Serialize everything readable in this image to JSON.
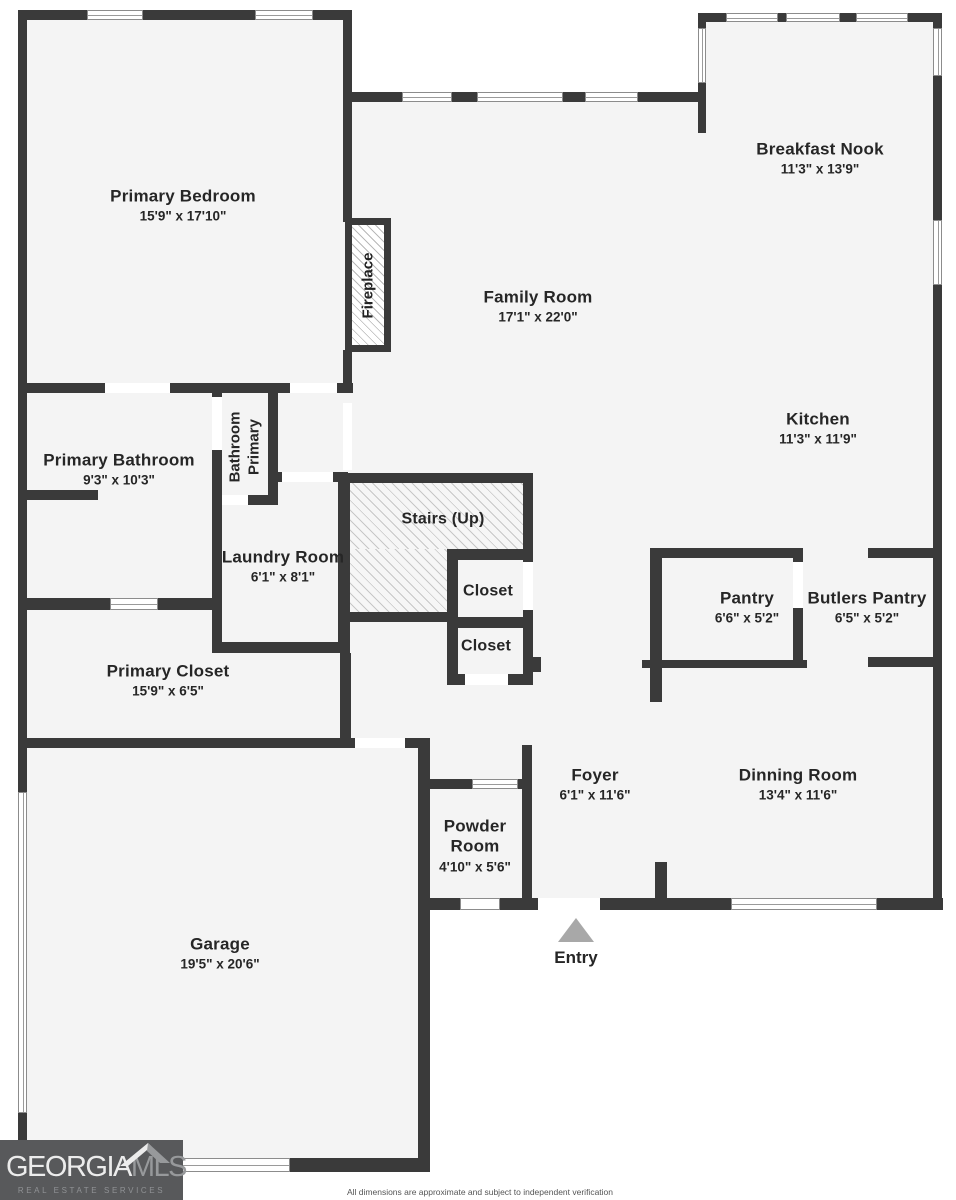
{
  "colors": {
    "wall": "#3a3a3a",
    "floor": "#f4f4f4",
    "background": "#ffffff",
    "entry_arrow": "#a8a8a8",
    "logo_background": "#58595b"
  },
  "rooms": {
    "primary_bedroom": {
      "name": "Primary Bedroom",
      "dims": "15'9\" x 17'10\""
    },
    "breakfast_nook": {
      "name": "Breakfast Nook",
      "dims": "11'3\" x 13'9\""
    },
    "family_room": {
      "name": "Family Room",
      "dims": "17'1\" x 22'0\""
    },
    "kitchen": {
      "name": "Kitchen",
      "dims": "11'3\" x 11'9\""
    },
    "primary_bathroom": {
      "name": "Primary Bathroom",
      "dims": "9'3\" x 10'3\""
    },
    "laundry_room": {
      "name": "Laundry Room",
      "dims": "6'1\" x 8'1\""
    },
    "pantry": {
      "name": "Pantry",
      "dims": "6'6\" x 5'2\""
    },
    "butlers_pantry": {
      "name": "Butlers Pantry",
      "dims": "6'5\" x 5'2\""
    },
    "primary_closet": {
      "name": "Primary Closet",
      "dims": "15'9\" x 6'5\""
    },
    "foyer": {
      "name": "Foyer",
      "dims": "6'1\" x 11'6\""
    },
    "dinning_room": {
      "name": "Dinning Room",
      "dims": "13'4\" x 11'6\""
    },
    "powder_room": {
      "name_lines": [
        "Powder",
        "Room"
      ],
      "dims": "4'10\" x 5'6\""
    },
    "garage": {
      "name": "Garage",
      "dims": "19'5\" x 20'6\""
    }
  },
  "labels": {
    "fireplace": "Fireplace",
    "stairs": "Stairs (Up)",
    "closet_upper": "Closet",
    "closet_lower": "Closet",
    "entry": "Entry",
    "primary_bathroom_closet_lines": [
      "Primary",
      "Bathroom"
    ]
  },
  "logo": {
    "brand_primary": "GEORGIA",
    "brand_secondary": "MLS",
    "tagline": "REAL ESTATE SERVICES"
  },
  "footer": {
    "disclaimer": "All dimensions are approximate and subject to independent verification"
  }
}
